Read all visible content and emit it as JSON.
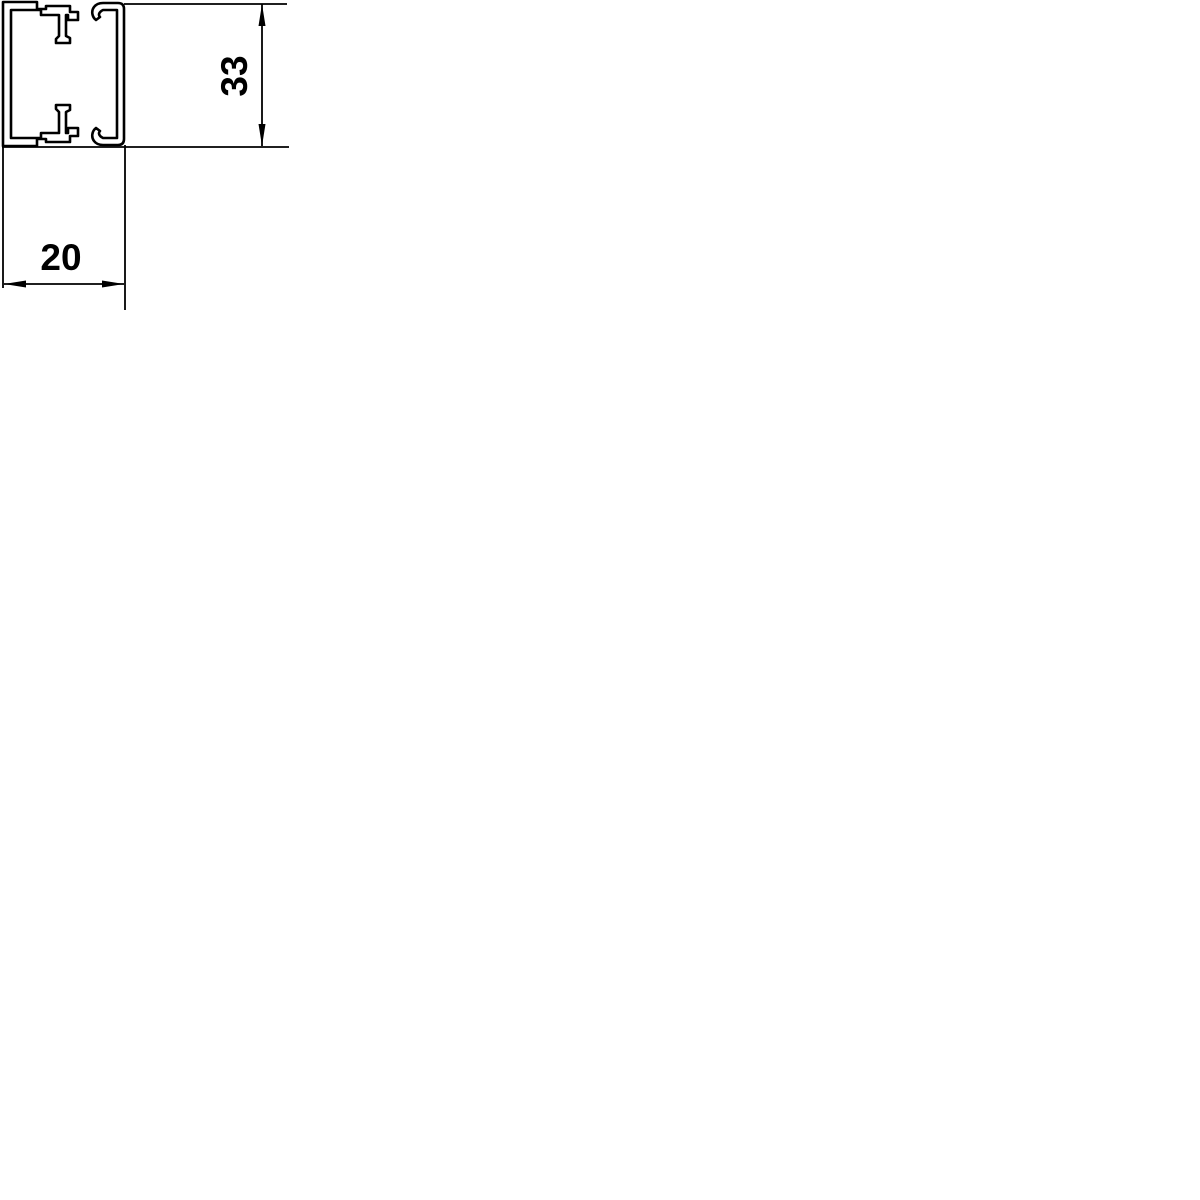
{
  "canvas": {
    "background_color": "#ffffff",
    "line_color": "#000000"
  },
  "drawing": {
    "dimensions": {
      "height": {
        "value": "33"
      },
      "width": {
        "value": "20"
      }
    }
  }
}
